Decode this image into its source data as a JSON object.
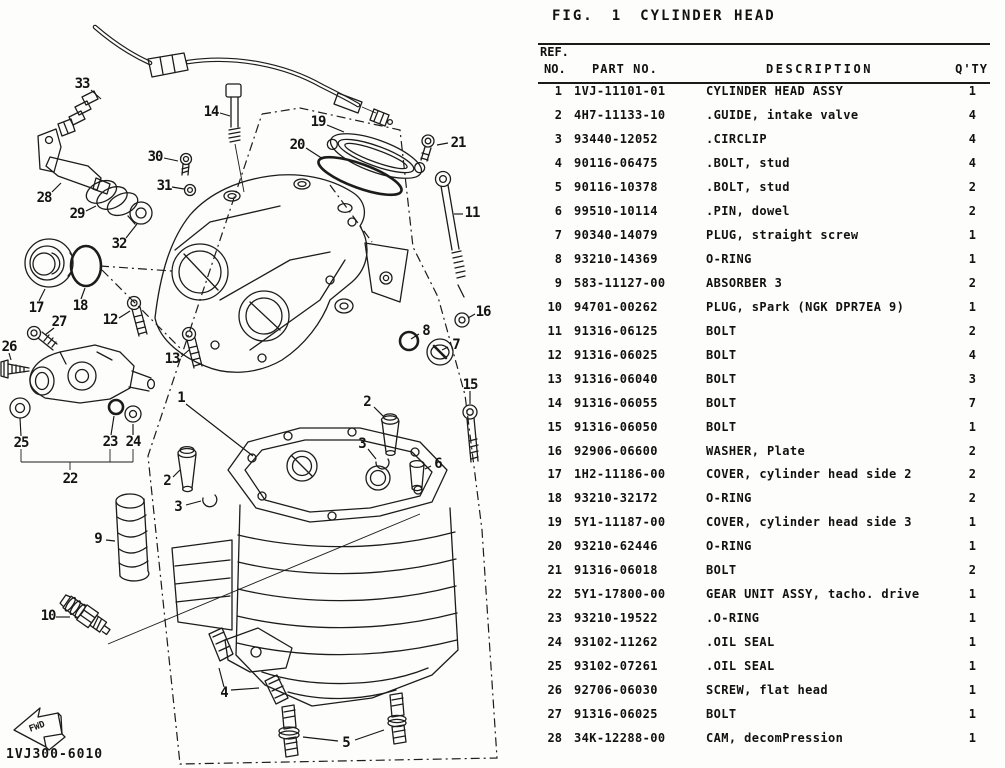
{
  "page": {
    "paper": "#fdfdfc",
    "ink": "#1c1c1c"
  },
  "figure_header": {
    "fig_label": "FIG.",
    "fig_number": "1",
    "fig_title": "CYLINDER HEAD"
  },
  "parts_table": {
    "headers": {
      "ref_line1": "REF.",
      "ref_line2": "NO.",
      "part": "PART NO.",
      "description": "DESCRIPTION",
      "qty": "Q'TY"
    },
    "rows": [
      {
        "ref": "1",
        "part": "1VJ-11101-01",
        "description": "CYLINDER HEAD ASSY",
        "qty": "1"
      },
      {
        "ref": "2",
        "part": "4H7-11133-10",
        "description": ".GUIDE, intake valve",
        "qty": "4"
      },
      {
        "ref": "3",
        "part": "93440-12052",
        "description": ".CIRCLIP",
        "qty": "4"
      },
      {
        "ref": "4",
        "part": "90116-06475",
        "description": ".BOLT, stud",
        "qty": "4"
      },
      {
        "ref": "5",
        "part": "90116-10378",
        "description": ".BOLT, stud",
        "qty": "2"
      },
      {
        "ref": "6",
        "part": "99510-10114",
        "description": ".PIN, dowel",
        "qty": "2"
      },
      {
        "ref": "7",
        "part": "90340-14079",
        "description": "PLUG, straight screw",
        "qty": "1"
      },
      {
        "ref": "8",
        "part": "93210-14369",
        "description": "O-RING",
        "qty": "1"
      },
      {
        "ref": "9",
        "part": "583-11127-00",
        "description": "ABSORBER 3",
        "qty": "2"
      },
      {
        "ref": "10",
        "part": "94701-00262",
        "description": "PLUG, sPark (NGK DPR7EA 9)",
        "qty": "1"
      },
      {
        "ref": "11",
        "part": "91316-06125",
        "description": "BOLT",
        "qty": "2"
      },
      {
        "ref": "12",
        "part": "91316-06025",
        "description": "BOLT",
        "qty": "4"
      },
      {
        "ref": "13",
        "part": "91316-06040",
        "description": "BOLT",
        "qty": "3"
      },
      {
        "ref": "14",
        "part": "91316-06055",
        "description": "BOLT",
        "qty": "7"
      },
      {
        "ref": "15",
        "part": "91316-06050",
        "description": "BOLT",
        "qty": "1"
      },
      {
        "ref": "16",
        "part": "92906-06600",
        "description": "WASHER, Plate",
        "qty": "2"
      },
      {
        "ref": "17",
        "part": "1H2-11186-00",
        "description": "COVER, cylinder head side 2",
        "qty": "2"
      },
      {
        "ref": "18",
        "part": "93210-32172",
        "description": "O-RING",
        "qty": "2"
      },
      {
        "ref": "19",
        "part": "5Y1-11187-00",
        "description": "COVER, cylinder head side 3",
        "qty": "1"
      },
      {
        "ref": "20",
        "part": "93210-62446",
        "description": "O-RING",
        "qty": "1"
      },
      {
        "ref": "21",
        "part": "91316-06018",
        "description": "BOLT",
        "qty": "2"
      },
      {
        "ref": "22",
        "part": "5Y1-17800-00",
        "description": "GEAR UNIT ASSY, tacho. drive",
        "qty": "1"
      },
      {
        "ref": "23",
        "part": "93210-19522",
        "description": ".O-RING",
        "qty": "1"
      },
      {
        "ref": "24",
        "part": "93102-11262",
        "description": ".OIL SEAL",
        "qty": "1"
      },
      {
        "ref": "25",
        "part": "93102-07261",
        "description": ".OIL SEAL",
        "qty": "1"
      },
      {
        "ref": "26",
        "part": "92706-06030",
        "description": "SCREW, flat head",
        "qty": "1"
      },
      {
        "ref": "27",
        "part": "91316-06025",
        "description": "BOLT",
        "qty": "1"
      },
      {
        "ref": "28",
        "part": "34K-12288-00",
        "description": "CAM, decomPression",
        "qty": "1"
      }
    ]
  },
  "diagram": {
    "drawing_code": "1VJ300-6010",
    "fwd_label": "FWD",
    "callouts": [
      {
        "n": "33",
        "x": 82,
        "y": 84,
        "leaders": [
          [
            91,
            90,
            101,
            99
          ]
        ]
      },
      {
        "n": "14",
        "x": 211,
        "y": 112,
        "leaders": [
          [
            220,
            113,
            230,
            116
          ]
        ]
      },
      {
        "n": "19",
        "x": 318,
        "y": 122,
        "leaders": [
          [
            327,
            125,
            344,
            132
          ]
        ]
      },
      {
        "n": "20",
        "x": 297,
        "y": 145,
        "leaders": [
          [
            306,
            148,
            323,
            159
          ]
        ]
      },
      {
        "n": "21",
        "x": 458,
        "y": 143,
        "leaders": [
          [
            448,
            143,
            437,
            145
          ]
        ]
      },
      {
        "n": "30",
        "x": 155,
        "y": 157,
        "leaders": [
          [
            164,
            158,
            178,
            161
          ]
        ]
      },
      {
        "n": "31",
        "x": 164,
        "y": 186,
        "leaders": [
          [
            172,
            187,
            184,
            189
          ]
        ]
      },
      {
        "n": "28",
        "x": 44,
        "y": 198,
        "leaders": [
          [
            52,
            192,
            61,
            183
          ]
        ]
      },
      {
        "n": "29",
        "x": 77,
        "y": 214,
        "leaders": [
          [
            86,
            211,
            96,
            206
          ]
        ]
      },
      {
        "n": "32",
        "x": 119,
        "y": 244,
        "leaders": [
          [
            126,
            238,
            137,
            224
          ]
        ]
      },
      {
        "n": "11",
        "x": 472,
        "y": 213,
        "leaders": [
          [
            463,
            214,
            454,
            214
          ]
        ]
      },
      {
        "n": "17",
        "x": 36,
        "y": 308,
        "leaders": [
          [
            39,
            301,
            45,
            289
          ]
        ]
      },
      {
        "n": "18",
        "x": 80,
        "y": 306,
        "leaders": [
          [
            81,
            299,
            85,
            288
          ]
        ]
      },
      {
        "n": "12",
        "x": 110,
        "y": 320,
        "leaders": [
          [
            119,
            318,
            130,
            311
          ]
        ]
      },
      {
        "n": "27",
        "x": 59,
        "y": 322,
        "leaders": [
          [
            54,
            328,
            45,
            335
          ]
        ]
      },
      {
        "n": "26",
        "x": 9,
        "y": 347,
        "leaders": [
          [
            9,
            353,
            11,
            360
          ]
        ]
      },
      {
        "n": "13",
        "x": 172,
        "y": 359,
        "leaders": [
          [
            181,
            357,
            189,
            350
          ]
        ]
      },
      {
        "n": "8",
        "x": 426,
        "y": 331,
        "leaders": [
          [
            419,
            334,
            411,
            339
          ]
        ]
      },
      {
        "n": "7",
        "x": 456,
        "y": 345,
        "leaders": [
          [
            448,
            347,
            442,
            350
          ]
        ]
      },
      {
        "n": "16",
        "x": 483,
        "y": 312,
        "leaders": [
          [
            475,
            314,
            468,
            318
          ]
        ]
      },
      {
        "n": "1",
        "x": 181,
        "y": 398,
        "leaders": [
          [
            186,
            404,
            253,
            456
          ]
        ]
      },
      {
        "n": "15",
        "x": 470,
        "y": 385,
        "leaders": [
          [
            470,
            391,
            470,
            404
          ]
        ]
      },
      {
        "n": "2",
        "x": 367,
        "y": 402,
        "leaders": [
          [
            374,
            407,
            384,
            417
          ]
        ]
      },
      {
        "n": "2",
        "x": 167,
        "y": 481,
        "leaders": [
          [
            173,
            477,
            180,
            470
          ]
        ]
      },
      {
        "n": "3",
        "x": 362,
        "y": 444,
        "leaders": [
          [
            368,
            449,
            376,
            459
          ]
        ]
      },
      {
        "n": "3",
        "x": 178,
        "y": 507,
        "leaders": [
          [
            186,
            505,
            201,
            501
          ]
        ]
      },
      {
        "n": "25",
        "x": 21,
        "y": 443,
        "leaders": [
          [
            21,
            436,
            20,
            418
          ]
        ]
      },
      {
        "n": "23",
        "x": 110,
        "y": 442,
        "leaders": [
          [
            111,
            435,
            114,
            416
          ]
        ]
      },
      {
        "n": "24",
        "x": 133,
        "y": 442,
        "leaders": [
          [
            133,
            435,
            133,
            424
          ]
        ]
      },
      {
        "n": "22",
        "x": 70,
        "y": 479,
        "leaders": []
      },
      {
        "n": "9",
        "x": 98,
        "y": 539,
        "leaders": [
          [
            106,
            540,
            115,
            541
          ]
        ]
      },
      {
        "n": "10",
        "x": 48,
        "y": 616,
        "leaders": [
          [
            56,
            617,
            70,
            617
          ]
        ]
      },
      {
        "n": "6",
        "x": 438,
        "y": 464,
        "leaders": [
          [
            431,
            466,
            425,
            469
          ]
        ]
      },
      {
        "n": "4",
        "x": 224,
        "y": 693,
        "leaders": [
          [
            224,
            687,
            219,
            668
          ],
          [
            231,
            690,
            259,
            688
          ]
        ]
      },
      {
        "n": "5",
        "x": 346,
        "y": 743,
        "leaders": [
          [
            338,
            741,
            303,
            737
          ],
          [
            355,
            740,
            384,
            730
          ]
        ]
      }
    ]
  }
}
